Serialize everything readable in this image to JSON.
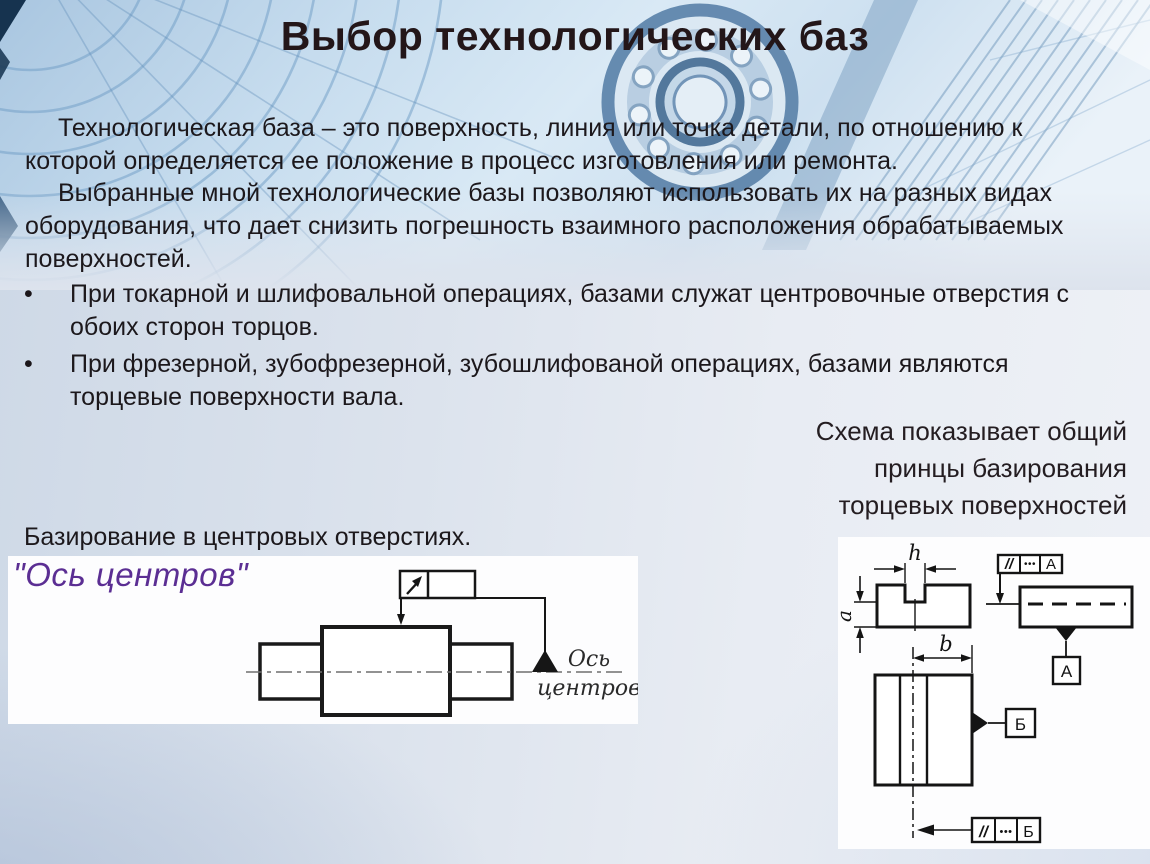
{
  "slide": {
    "title": "Выбор технологических баз",
    "paragraphs": [
      "Технологическая база – это поверхность, линия или точка детали, по отношению к\nкоторой определяется ее положение в процесс изготовления или ремонта.",
      "Выбранные мной технологические базы позволяют использовать их на разных видах\nоборудования, что дает снизить погрешность взаимного расположения обрабатываемых\nповерхностей."
    ],
    "bullets": [
      {
        "marker": "•",
        "text": "При токарной и шлифовальной операциях, базами служат центровочные отверстия с\nобоих сторон торцов."
      },
      {
        "marker": "•",
        "text": "При фрезерной, зубофрезерной, зубошлифованой операциях, базами являются\nторцевые поверхности вала."
      }
    ],
    "right_note": "Схема показывает общий\nпринцы базирования\nторцевых поверхностей",
    "caption": "Базирование в центровых отверстиях.",
    "colors": {
      "accent_purple": "#5B2E93",
      "text": "#1B161A",
      "panel": "#FDFDFE",
      "header_navy": "#16334F"
    }
  },
  "left_figure": {
    "quote_label": "\"Ось центров\"",
    "axis_label_line1": "Ось",
    "axis_label_line2": "центров"
  },
  "right_figure": {
    "dim_h": "h",
    "dim_a": "a",
    "dim_b": "b",
    "datum_box_a": "А",
    "datum_box_b": "Б",
    "fcf_top": {
      "parallel": "//",
      "dots": "•••",
      "datum": "А"
    },
    "fcf_bottom": {
      "parallel": "//",
      "dots": "•••",
      "datum": "Б"
    }
  }
}
